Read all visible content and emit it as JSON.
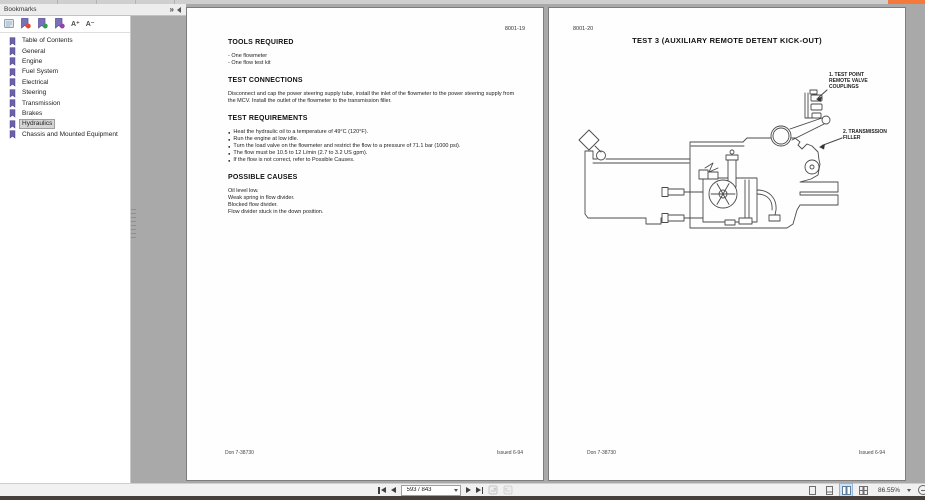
{
  "window": {
    "top_accent_color": "#f4793b"
  },
  "sidebar": {
    "title": "Bookmarks",
    "expand_icon": "»",
    "toolbar": {
      "font_increase_label": "A⁺",
      "font_decrease_label": "A⁻",
      "bookmark_dot_colors": [
        "#e2482e",
        "#2f9e4f",
        "#9a3fb0"
      ],
      "bookmark_icon_color": "#6b61a8"
    },
    "items": [
      "Table of Contents",
      "General",
      "Engine",
      "Fuel System",
      "Electrical",
      "Steering",
      "Transmission",
      "Brakes",
      "Hydraulics",
      "Chassis and Mounted Equipment"
    ],
    "selected_item": "Hydraulics"
  },
  "left_page": {
    "page_number": "8001-19",
    "tools_heading": "TOOLS REQUIRED",
    "tools_lines": [
      "- One flowmeter",
      "- One flow test kit"
    ],
    "connections_heading": "TEST CONNECTIONS",
    "connections_text": "Disconnect and cap the power steering supply tube, install the inlet of the flowmeter to the power steering supply from the MCV. Install the outlet of the flowmeter to the transmission filler.",
    "requirements_heading": "TEST REQUIREMENTS",
    "requirements_bullets": [
      "Heat the hydraulic oil to a temperature of 49°C (120°F).",
      "Run the engine at low idle.",
      "Turn the load valve on the flowmeter and restrict the flow to a pressure of 71.1 bar (1000 psi).",
      "The flow must be 10.5 to 12 L/min (2.7 to 3.2 US gpm).",
      "If the flow is not correct, refer to Possible Causes."
    ],
    "causes_heading": "POSSIBLE CAUSES",
    "causes_lines": [
      "Oil level low.",
      "Weak spring in flow divider.",
      "Blocked flow divider.",
      "Flow divider stuck in the down position."
    ],
    "footer_left": "Don 7-38730",
    "footer_right": "Issued 6-94"
  },
  "right_page": {
    "page_number": "8001-20",
    "title": "TEST 3 (AUXILIARY REMOTE DETENT KICK-OUT)",
    "callout1_lines": [
      "1. TEST POINT",
      "REMOTE VALVE",
      "COUPLINGS"
    ],
    "callout2_lines": [
      "2. TRANSMISSION",
      "FILLER"
    ],
    "footer_left": "Don 7-38730",
    "footer_right": "Issued 6-94"
  },
  "bottom_toolbar": {
    "page_field_value": "593 / 843",
    "zoom_level": "86.55%"
  }
}
